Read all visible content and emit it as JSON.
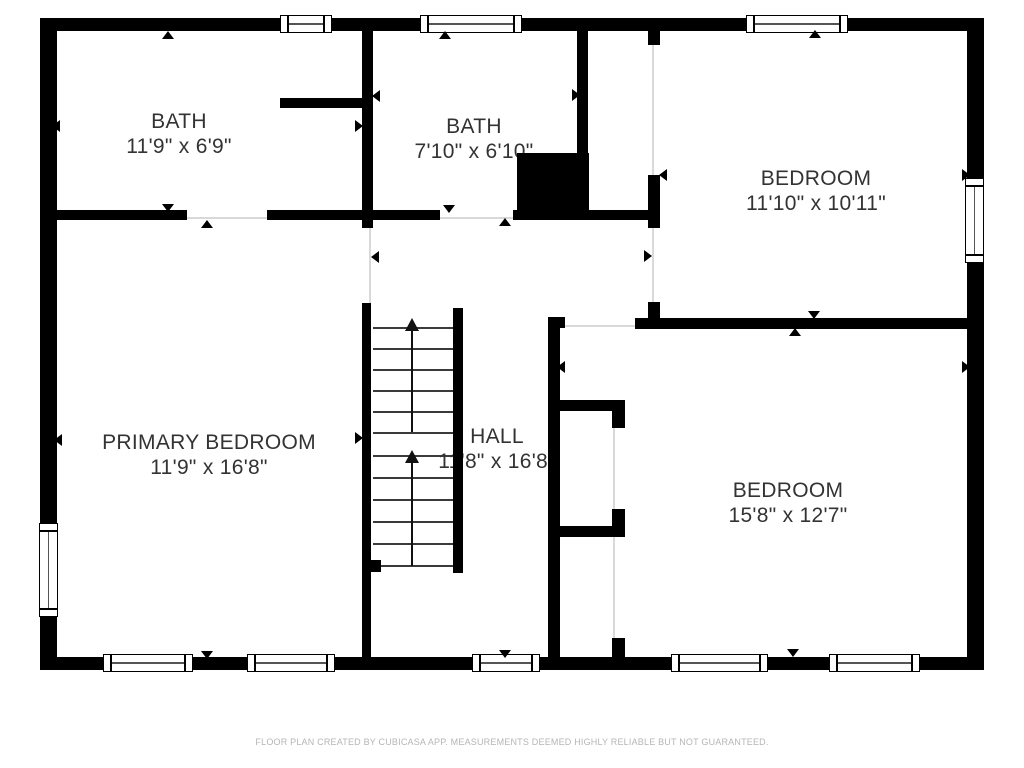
{
  "colors": {
    "background": "#ffffff",
    "wall": "#000000",
    "label": "#333333",
    "footer_text": "#b5b5b5",
    "door_line": "#d9d9d9",
    "stair_tread": "#3a3a3a"
  },
  "rooms": [
    {
      "id": "bath-1",
      "name": "BATH",
      "dims": "11'9\" x 6'9\""
    },
    {
      "id": "bath-2",
      "name": "BATH",
      "dims": "7'10\" x 6'10\""
    },
    {
      "id": "bedroom-1",
      "name": "BEDROOM",
      "dims": "11'10\" x 10'11\""
    },
    {
      "id": "primary-bedroom",
      "name": "PRIMARY BEDROOM",
      "dims": "11'9\" x 16'8\""
    },
    {
      "id": "hall",
      "name": "HALL",
      "dims": "11'8\" x 16'8\""
    },
    {
      "id": "bedroom-2",
      "name": "BEDROOM",
      "dims": "15'8\" x 12'7\""
    }
  ],
  "footer": {
    "text": "FLOOR PLAN CREATED BY CUBICASA APP. MEASUREMENTS DEEMED HIGHLY RELIABLE BUT NOT GUARANTEED."
  },
  "geometry": {
    "walls": [
      [
        40,
        18,
        944,
        13
      ],
      [
        40,
        657,
        944,
        13
      ],
      [
        40,
        18,
        17,
        652
      ],
      [
        967,
        18,
        17,
        652
      ],
      [
        362,
        31,
        11,
        197
      ],
      [
        280,
        98,
        82,
        10
      ],
      [
        57,
        210,
        130,
        10
      ],
      [
        267,
        210,
        106,
        10
      ],
      [
        373,
        210,
        67,
        10
      ],
      [
        513,
        210,
        135,
        10
      ],
      [
        517,
        153,
        72,
        62
      ],
      [
        577,
        31,
        11,
        125
      ],
      [
        648,
        31,
        12,
        14
      ],
      [
        648,
        175,
        12,
        53
      ],
      [
        648,
        302,
        12,
        16
      ],
      [
        635,
        318,
        349,
        11
      ],
      [
        548,
        317,
        12,
        340
      ],
      [
        548,
        317,
        17,
        11
      ],
      [
        560,
        400,
        63,
        11
      ],
      [
        612,
        400,
        13,
        28
      ],
      [
        560,
        526,
        63,
        11
      ],
      [
        612,
        509,
        13,
        28
      ],
      [
        612,
        638,
        13,
        19
      ],
      [
        362,
        303,
        9,
        354
      ],
      [
        371,
        560,
        10,
        12
      ],
      [
        453,
        308,
        10,
        265
      ]
    ],
    "windows": [
      [
        280,
        15,
        52,
        18
      ],
      [
        420,
        15,
        102,
        18
      ],
      [
        746,
        15,
        102,
        18
      ],
      [
        103,
        654,
        90,
        18
      ],
      [
        247,
        654,
        88,
        18
      ],
      [
        472,
        654,
        68,
        18
      ],
      [
        671,
        654,
        97,
        18
      ],
      [
        829,
        654,
        91,
        18
      ],
      [
        965,
        178,
        19,
        85
      ],
      [
        39,
        523,
        19,
        94
      ]
    ],
    "door_lines": [
      [
        187,
        217,
        80,
        2
      ],
      [
        440,
        217,
        73,
        2
      ],
      [
        369,
        228,
        2,
        75
      ],
      [
        652,
        45,
        2,
        130
      ],
      [
        652,
        228,
        2,
        74
      ],
      [
        565,
        325,
        70,
        2
      ],
      [
        613,
        428,
        2,
        81
      ],
      [
        613,
        537,
        2,
        101
      ]
    ],
    "arrows": [
      [
        168,
        35,
        "up"
      ],
      [
        56,
        126,
        "left"
      ],
      [
        359,
        126,
        "right"
      ],
      [
        376,
        96,
        "left"
      ],
      [
        445,
        35,
        "up"
      ],
      [
        168,
        208,
        "down"
      ],
      [
        207,
        224,
        "up"
      ],
      [
        449,
        209,
        "down"
      ],
      [
        505,
        222,
        "up"
      ],
      [
        576,
        95,
        "right"
      ],
      [
        815,
        34,
        "up"
      ],
      [
        663,
        175,
        "left"
      ],
      [
        966,
        175,
        "right"
      ],
      [
        814,
        315,
        "down"
      ],
      [
        795,
        332,
        "up"
      ],
      [
        648,
        256,
        "right"
      ],
      [
        966,
        367,
        "right"
      ],
      [
        793,
        653,
        "down"
      ],
      [
        58,
        440,
        "left"
      ],
      [
        359,
        438,
        "right"
      ],
      [
        207,
        655,
        "down"
      ],
      [
        505,
        654,
        "down"
      ],
      [
        561,
        367,
        "left"
      ],
      [
        375,
        257,
        "left"
      ]
    ],
    "stairs": {
      "x1": 373,
      "x2": 453,
      "cx": 412,
      "tread_ys": [
        327,
        348,
        369,
        390,
        411,
        432,
        455,
        477,
        499,
        521,
        543,
        565
      ],
      "flights": [
        {
          "arrow_y": 318,
          "line_y1": 330,
          "line_y2": 432
        },
        {
          "arrow_y": 450,
          "line_y1": 462,
          "line_y2": 566
        }
      ]
    }
  }
}
